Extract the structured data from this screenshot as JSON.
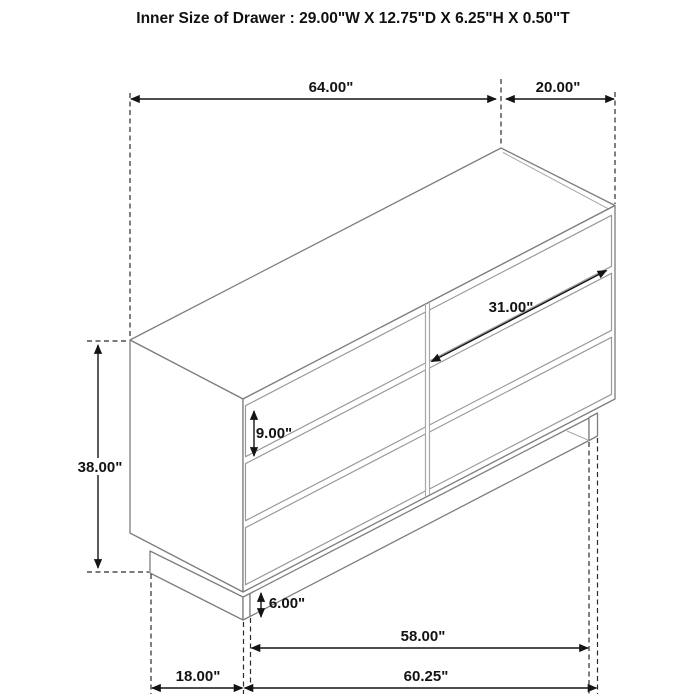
{
  "title": "Inner Size of Drawer : 29.00\"W X 12.75\"D X 6.25\"H X 0.50\"T",
  "diagram": {
    "subject": "six-drawer-dresser-isometric",
    "line_color": "#7e7e7e",
    "dimension_color": "#141414",
    "background": "#ffffff"
  },
  "dims": {
    "overall_width": "64.00\"",
    "overall_depth": "20.00\"",
    "overall_height": "38.00\"",
    "top_drawer_height": "9.00\"",
    "drawer_front_width": "31.00\"",
    "base_height": "6.00\"",
    "inner_leg_span": "58.00\"",
    "outer_base_width": "60.25\"",
    "base_depth": "18.00\""
  }
}
